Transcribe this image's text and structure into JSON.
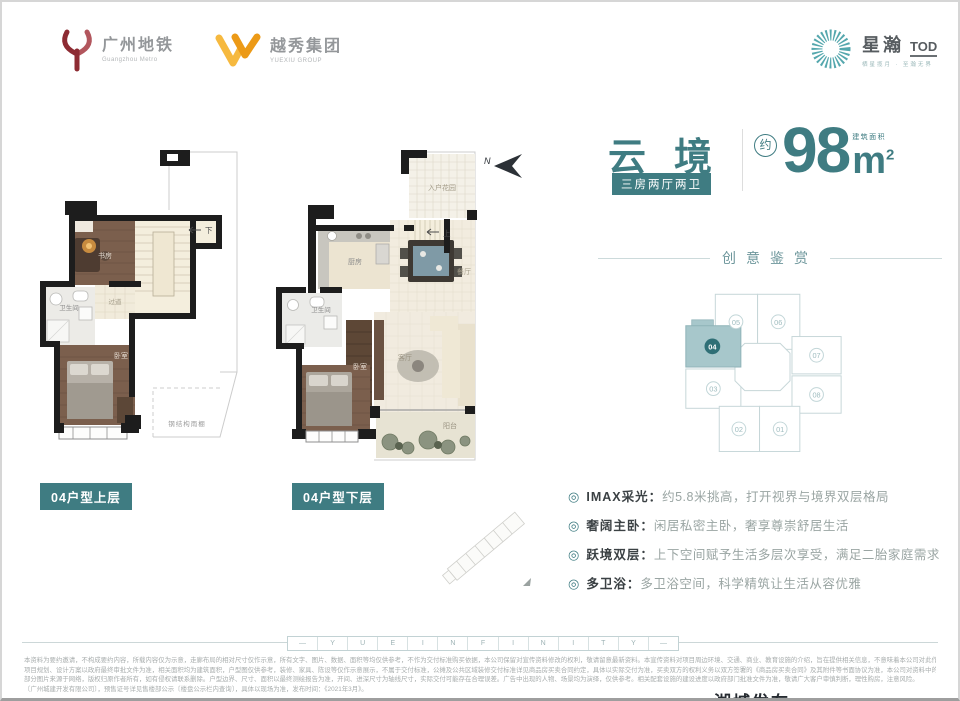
{
  "colors": {
    "accent": "#3f7c82",
    "accent_dark": "#2f6f76",
    "keyplan_highlight": "#a7c7cb",
    "wood": "#7b5f4d"
  },
  "header": {
    "metro": {
      "cn": "广州地铁",
      "en": "Guangzhou Metro"
    },
    "yuexiu": {
      "cn": "越秀集团",
      "en": "YUEXIU GROUP"
    },
    "brand": {
      "cn": "星瀚",
      "suffix": "TOD",
      "tagline": "栖星揽月 · 至瀚无界"
    }
  },
  "title": {
    "name": "云境",
    "spec_badge": "三房两厅两卫",
    "approx": "约",
    "area": "98",
    "unit": "m",
    "sup": "2",
    "area_label": "建筑面积"
  },
  "section": {
    "heading": "创意鉴赏"
  },
  "keyplan": {
    "highlight": "04",
    "units": [
      "05",
      "06",
      "07",
      "08",
      "03",
      "02",
      "01"
    ]
  },
  "feature_icon": "◎",
  "features": [
    {
      "title": "IMAX采光：",
      "desc": "约5.8米挑高，打开视界与境界双层格局"
    },
    {
      "title": "奢阔主卧：",
      "desc": "闲居私密主卧，奢享尊崇舒居生活"
    },
    {
      "title": "跃境双层：",
      "desc": "上下空间赋予生活多层次享受，满足二胎家庭需求"
    },
    {
      "title": "多卫浴：",
      "desc": "多卫浴空间，科学精筑让生活从容优雅"
    }
  ],
  "plans": {
    "upper": {
      "badge": "04户型上层",
      "study": "书房",
      "bath": "卫生间",
      "corridor": "过道",
      "bedroom": "卧室",
      "stair": "下",
      "canopy": "钢结构雨棚"
    },
    "lower": {
      "badge": "04户型下层",
      "garden": "入户花园",
      "kitchen": "厨房",
      "dining": "餐厅",
      "bath": "卫生间",
      "living": "客厅",
      "bedroom": "卧室",
      "balcony": "阳台",
      "stair": "上",
      "north": "N"
    }
  },
  "footer": {
    "band_dash": "—",
    "band": [
      "Y",
      "U",
      "E",
      "I",
      "N",
      "F",
      "I",
      "N",
      "I",
      "T",
      "Y"
    ],
    "disclaimer": [
      "本资料为要约邀请，不构成要约内容，所载内容仅为示意，走廊布局的相对尺寸仅作示意，所有文字、图片、数据、面积等均仅供参考，不作为交付标准购买依据，本公司保留对宣传资料修改的权利，敬请留意最新资料。本宣传资料对项目周边环境、交通、商业、教育设施的介绍，旨在提供相关信息，不意味着本公司对此作出了承诺。",
      "项目规划、设计方案以政府最终审批文件为准，相关面积均为建筑面积，户型图仅供参考，装修、家具、陈设等仅作示意展示，不属于交付标准，公摊及公共区域装修交付标准详见商品房买卖合同约定，具体以实际交付为准，买卖双方的权利义务以双方签署的《商品房买卖合同》及其附件等书面协议为准，本公司对资料中的内容保留解释权。",
      "部分图片来源于网络，版权归原作者所有，如有侵权请联系删除。户型边界、尺寸、面积以最终测绘报告为准，开间、进深尺寸为轴线尺寸，实际交付可能存在合理误差。广告中出现的人物、场景均为演绎，仅供参考。相关配套设施的建设进度以政府部门批准文件为准，敬请广大客户审慎判断，理性购房，注意风险。",
      "〔广州城建开发有限公司〕，预售证号详见售楼部公示〔楼盘公示栏内查询〕，具体以现场为准，发布时间：《2021年3月》。"
    ],
    "watermark": "湖城发布"
  }
}
